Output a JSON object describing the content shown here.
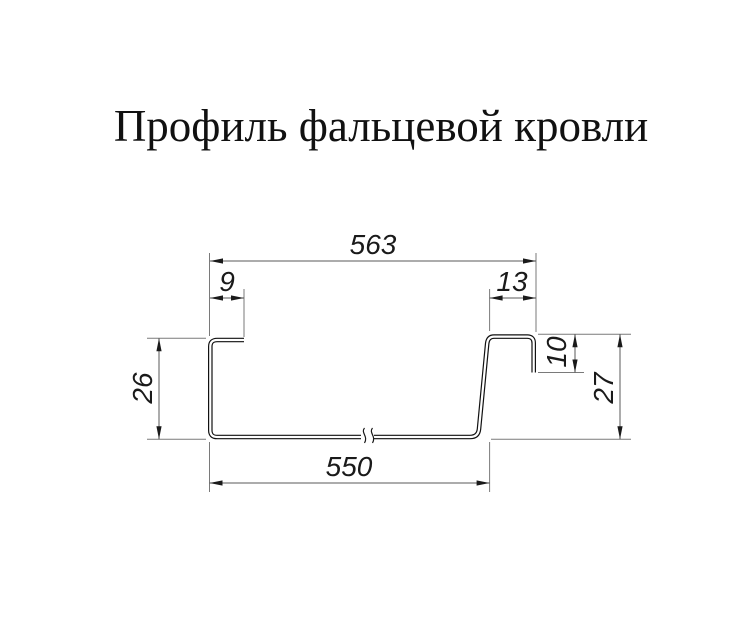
{
  "title": "Профиль фальцевой кровли",
  "drawing": {
    "dimensions": {
      "overall_width": "563",
      "left_flange_width": "9",
      "seam_hook_width": "13",
      "left_height": "26",
      "seam_hook_drop": "10",
      "right_height": "27",
      "bottom_width": "550"
    },
    "colors": {
      "background": "#ffffff",
      "profile_line": "#111111",
      "dimension_line": "#5a5a5a",
      "extension_line": "#7a7a7a",
      "text": "#1a1a1a"
    }
  }
}
